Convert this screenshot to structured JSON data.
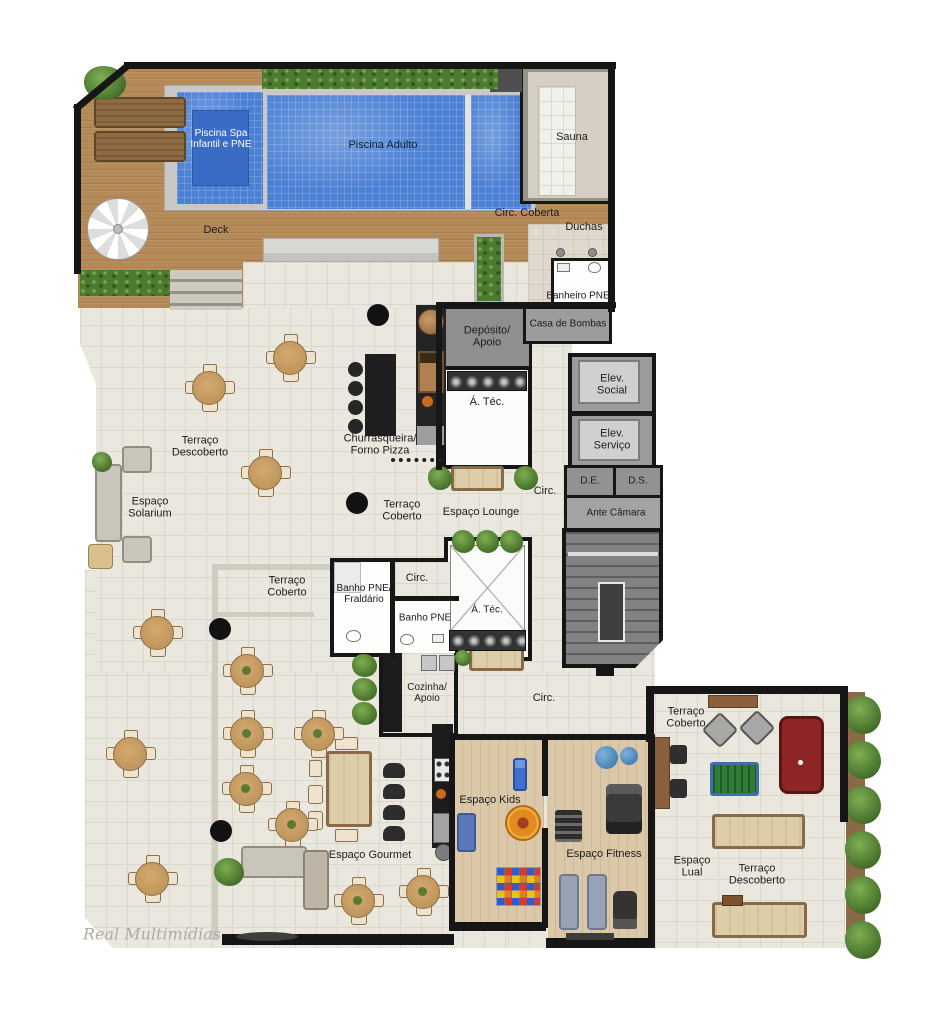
{
  "plan": {
    "type": "architectural-floor-plan-leisure-area",
    "language": "pt-BR"
  },
  "labels": {
    "piscina_spa": "Piscina Spa\nInfantil e PNE",
    "piscina_adulto": "Piscina Adulto",
    "sauna": "Sauna",
    "circ_coberta": "Circ. Coberta",
    "duchas": "Duchas",
    "deck": "Deck",
    "banheiro_pne": "Banheiro PNE",
    "casa_de_bombas": "Casa de Bombas",
    "deposito_apoio": "Depósito/\nApoio",
    "a_tec_1": "Á. Téc.",
    "elev_social": "Elev.\nSocial",
    "elev_servico": "Elev.\nServiço",
    "d_e": "D.E.",
    "d_s": "D.S.",
    "ante_camara": "Ante Câmara",
    "circ_1": "Circ.",
    "terraco_descoberto_1": "Terraço\nDescoberto",
    "espaco_solarium": "Espaço\nSolarium",
    "churrasqueira_forno_pizza": "Churrasqueira/\nForno Pizza",
    "terraco_coberto_1": "Terraço\nCoberto",
    "espaco_lounge": "Espaço Lounge",
    "terraco_coberto_2": "Terraço\nCoberto",
    "banho_pne_fraldario": "Banho PNE/\nFraldário",
    "circ_2": "Circ.",
    "banho_pne_2": "Banho PNE",
    "a_tec_2": "Á. Téc.",
    "cozinha_apoio": "Cozinha/\nApoio",
    "circ_3": "Circ.",
    "espaco_kids": "Espaço Kids",
    "espaco_fitness": "Espaço Fitness",
    "espaco_gourmet": "Espaço Gourmet",
    "terraco_coberto_3": "Terraço\nCoberto",
    "espaco_lual": "Espaço\nLual",
    "terraco_descoberto_2": "Terraço\nDescoberto",
    "watermark": "Real Multimídias"
  },
  "palette": {
    "pool_blue": "#4b80d4",
    "deck_wood": "#b58a59",
    "tile_floor": "#eae7de",
    "wood_floor": "#dbc8a9",
    "wall_black": "#161616",
    "service_gray": "#9c9c9c",
    "hedge_green": "#4d7a31",
    "pool_table_red": "#8e2424",
    "foosball_green": "#2e7c35"
  }
}
